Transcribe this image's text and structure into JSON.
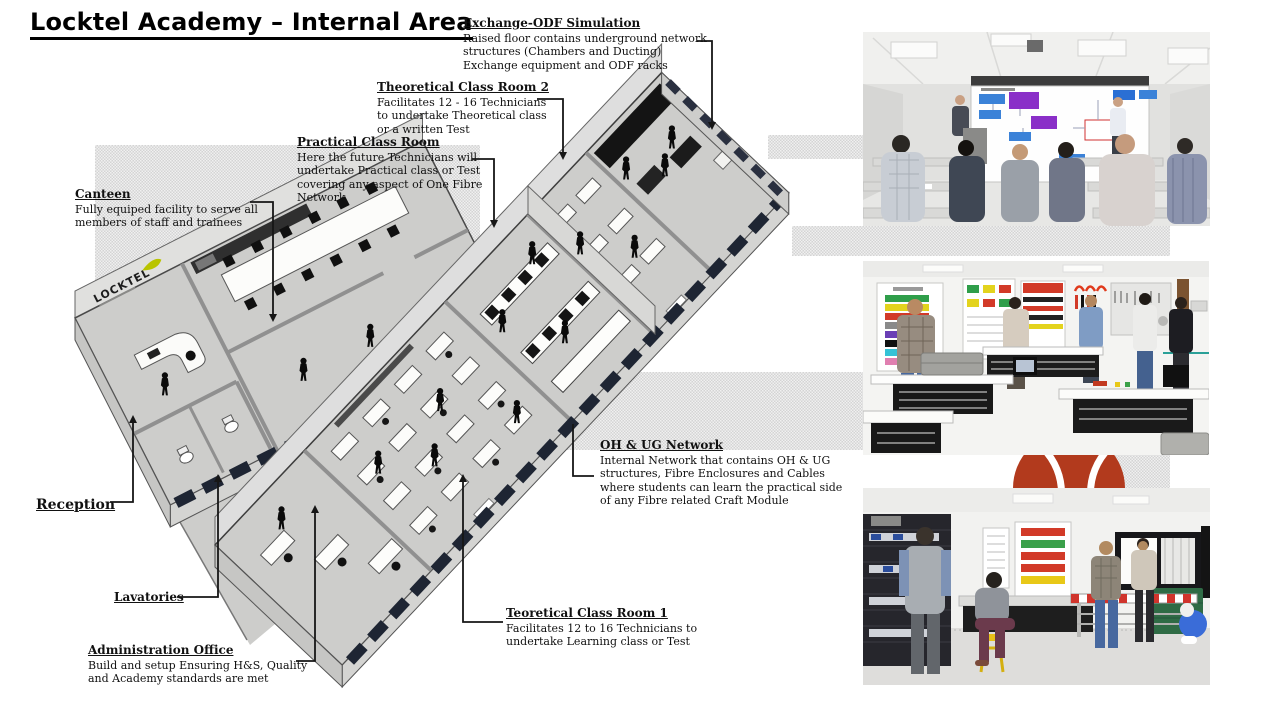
{
  "title": "Locktel Academy – Internal Area",
  "floorplan": {
    "logo_text": "LOCKTEL"
  },
  "annotations": {
    "exchange_odf": {
      "heading": "Exchange-ODF Simulation",
      "body": "Raised floor contains underground network\nstructures (Chambers and Ducting)\nExchange equipment and ODF racks"
    },
    "theoretical_2": {
      "heading": "Theoretical Class Room 2",
      "body": "Facilitates 12 - 16 Technicians\nto undertake Theoretical class\nor a written Test"
    },
    "practical": {
      "heading": "Practical Class Room",
      "body": "Here the future Technicians will\nundertake Practical class or Test\ncovering any aspect of One Fibre\nNetwork"
    },
    "canteen": {
      "heading": "Canteen",
      "body": "Fully equiped facility to serve all\nmembers of staff and trainees"
    },
    "reception": {
      "heading": "Reception",
      "body": ""
    },
    "lavatories": {
      "heading": "Lavatories",
      "body": ""
    },
    "admin": {
      "heading": "Administration Office",
      "body": "Build and setup Ensuring H&S, Quality\nand Academy standards are met"
    },
    "ohug": {
      "heading": "OH & UG Network",
      "body": "Internal Network that contains OH & UG\nstructures, Fibre Enclosures and Cables\nwhere students can learn the practical side\nof any Fibre related Craft Module"
    },
    "teoretical_1": {
      "heading": "Teoretical Class Room 1",
      "body": "Facilitates 12 to 16 Technicians to\nundertake Learning class or Test"
    }
  },
  "photos": [
    {
      "name": "theory-classroom-render"
    },
    {
      "name": "practical-lab-render"
    },
    {
      "name": "test-lab-render"
    }
  ]
}
